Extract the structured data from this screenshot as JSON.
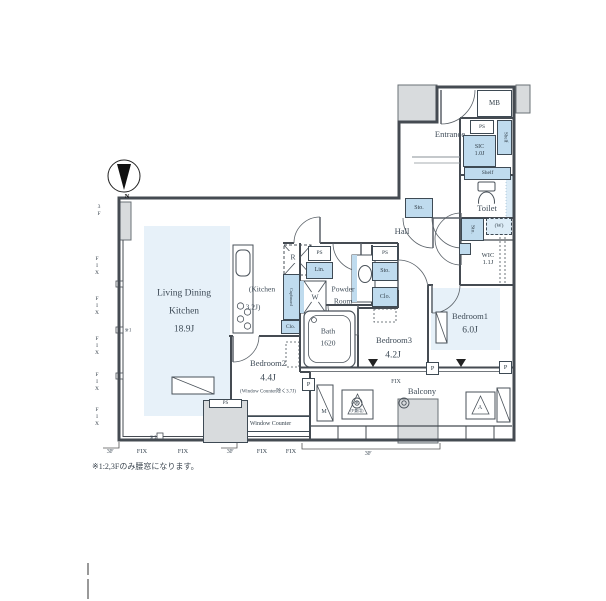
{
  "colors": {
    "room_fill": "#e7f1f9",
    "storage_fill": "#bfdbee",
    "wall": "#454b52",
    "gray_block": "#d8dbdd"
  },
  "compass": {
    "north": "N"
  },
  "note": "※1:2,3Fのみ腰窓になります。",
  "rooms": {
    "ldk": {
      "line1": "Living Dining",
      "line2": "Kitchen",
      "size": "18.9J"
    },
    "kitchen": {
      "line1": "(Kitchen",
      "line2": "3.2J)"
    },
    "bedroom1": {
      "name": "Bedroom1",
      "size": "6.0J"
    },
    "bedroom2": {
      "name": "Bedroom2",
      "size": "4.4J",
      "note": "(Window Counter除く3.7J)"
    },
    "bedroom3": {
      "name": "Bedroom3",
      "size": "4.2J"
    },
    "bath": {
      "name": "Bath",
      "size": "1620"
    },
    "powder_room": {
      "line1": "Powder",
      "line2": "Room"
    },
    "hall": {
      "name": "Hall"
    },
    "entrance": {
      "name": "Entrance"
    },
    "toilet": {
      "name": "Toilet"
    },
    "balcony": {
      "name": "Balcony"
    },
    "wic": {
      "name": "WIC",
      "size": "1.1J"
    },
    "sic": {
      "name": "SIC",
      "size": "1.0J"
    }
  },
  "features": {
    "mb": "MB",
    "ps": "PS",
    "sto": "Sto.",
    "lin": "Lin.",
    "clo": "Clo.",
    "cupboard": "Cupboard",
    "shelf": "Shelf",
    "washer_space": "(W)",
    "washing_machine": "W",
    "refrigerator": "R",
    "meter": "M",
    "hatch_a": "A",
    "hatch_b": "B",
    "hatch_b_note": "(F兼用)",
    "pillar": "P",
    "window_counter": "Window Counter"
  },
  "window_labels": {
    "fix": "FIX",
    "floor": "3F",
    "ref": "※1"
  }
}
